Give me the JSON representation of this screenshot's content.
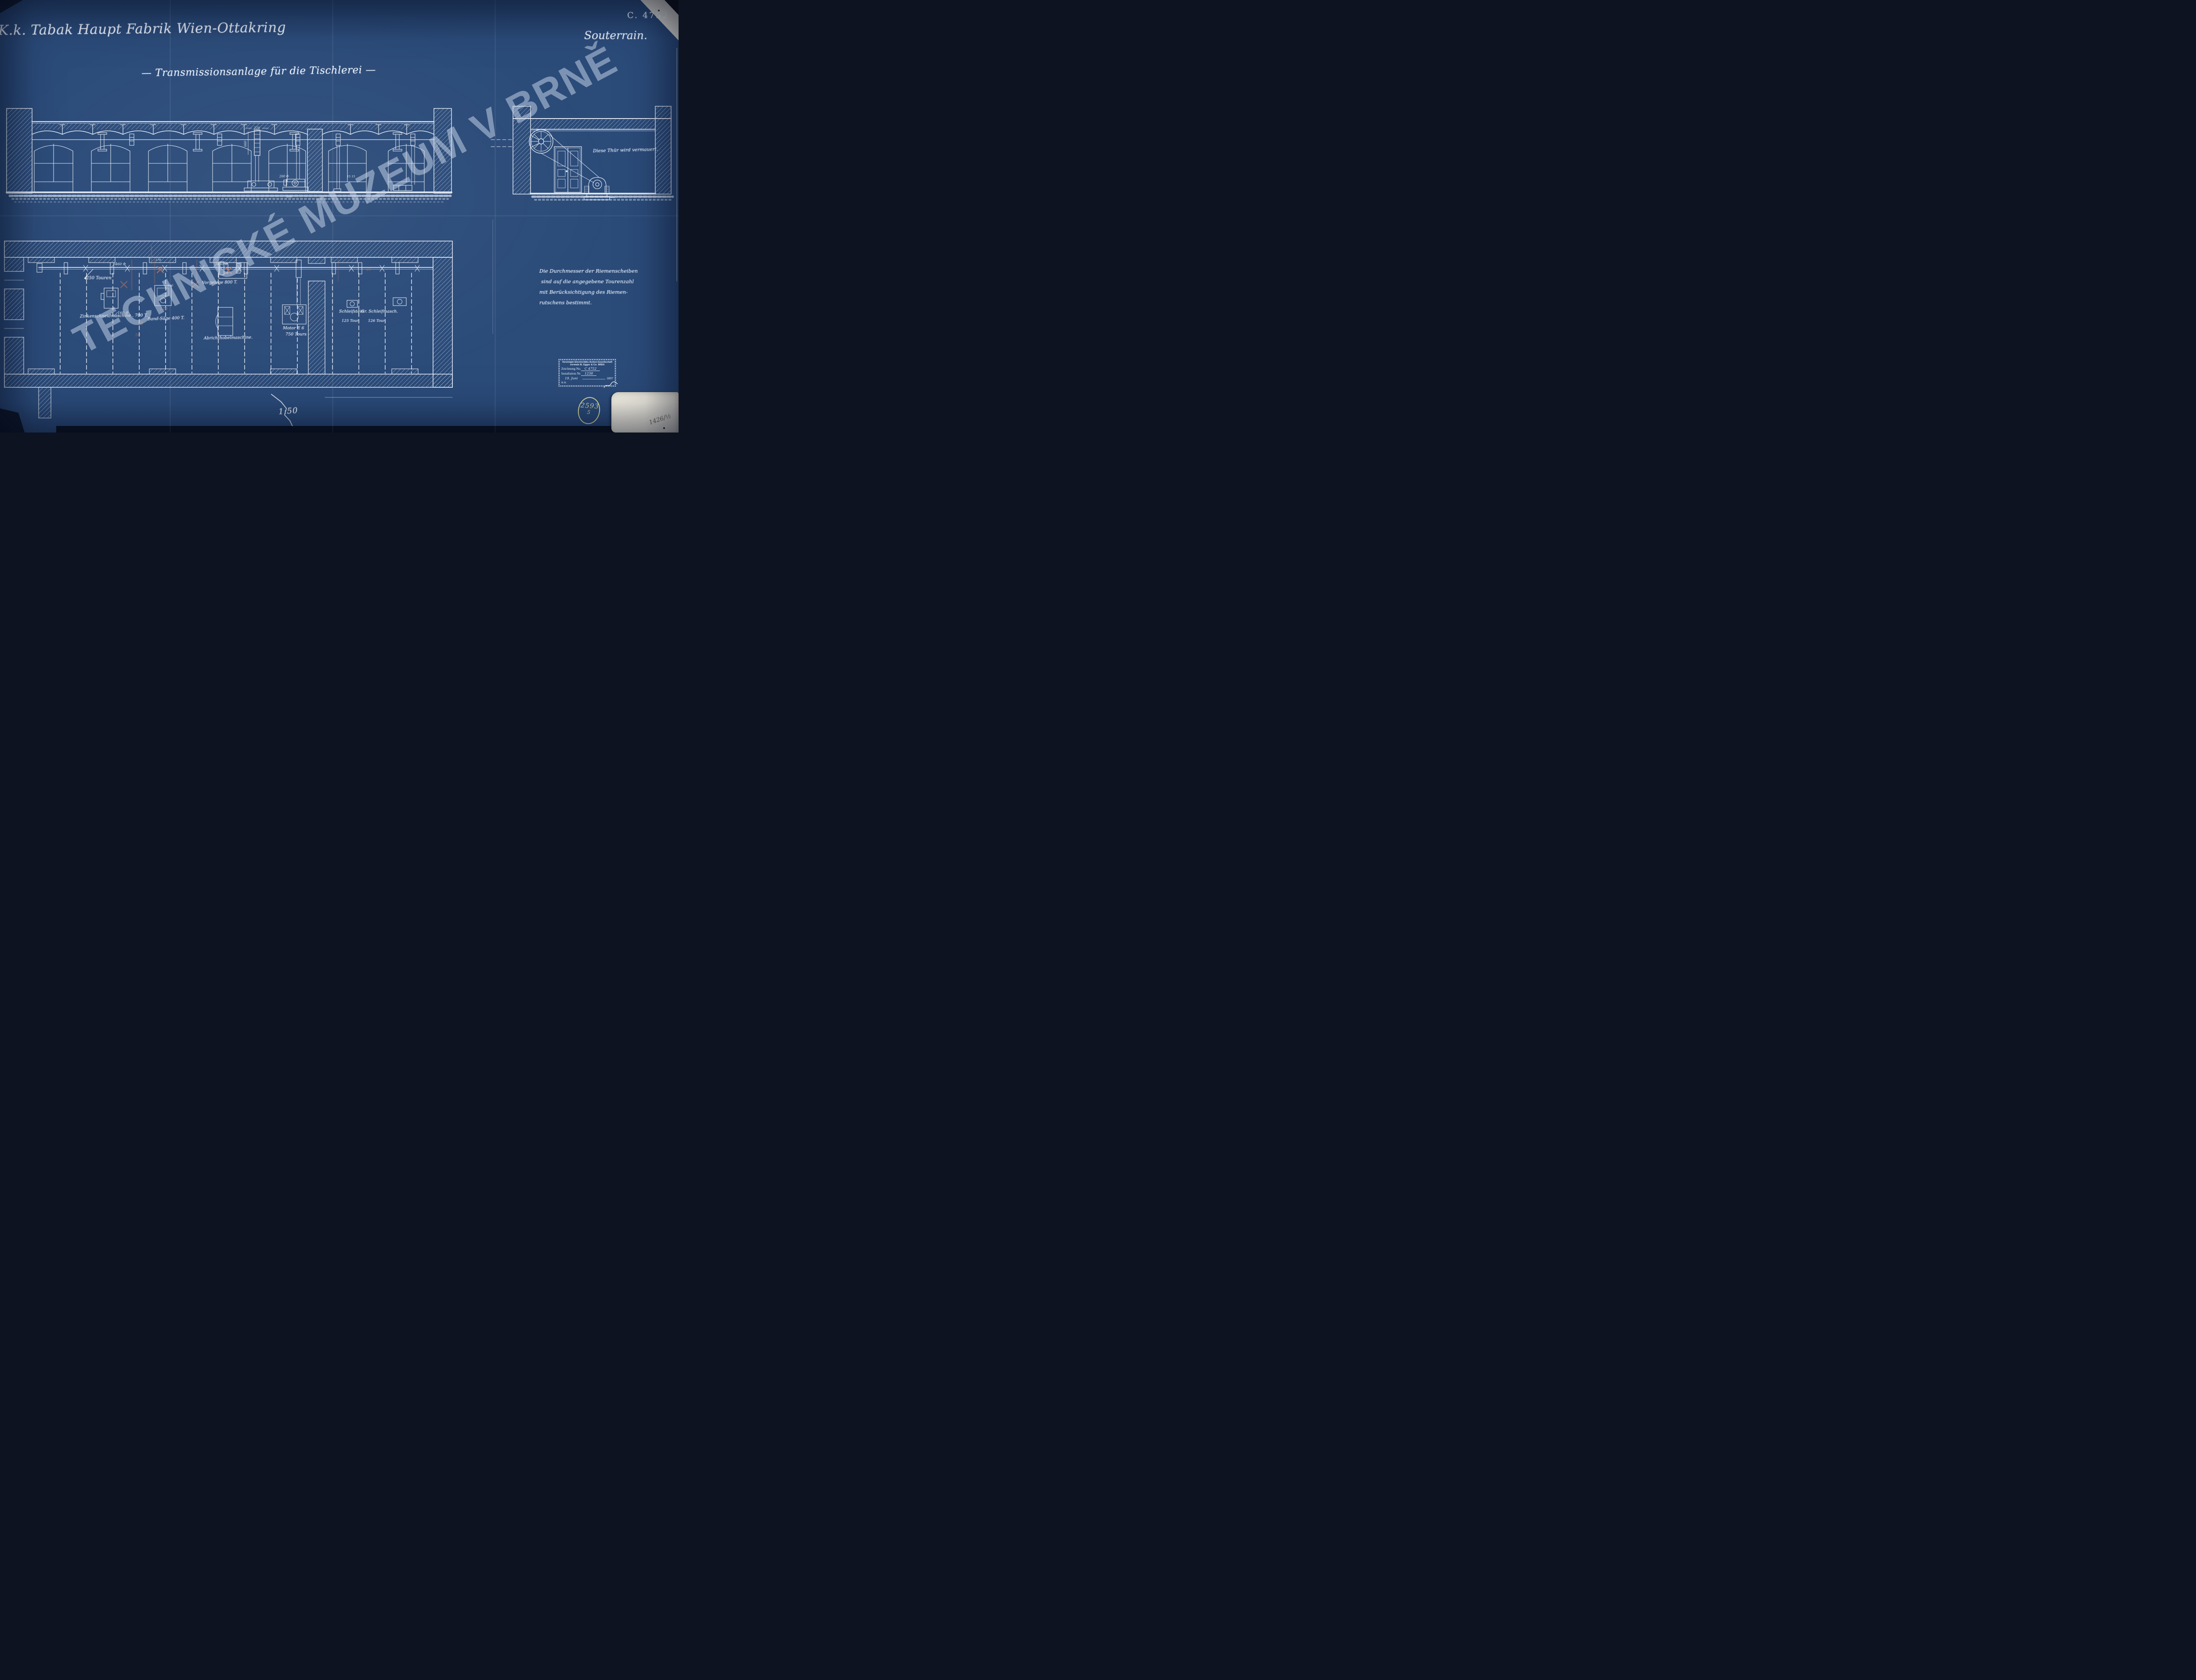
{
  "header": {
    "title": "K.k. Tabak Haupt Fabrik Wien-Ottakring",
    "subtitle": "— Transmissionsanlage für die Tischlerei —",
    "drawing_number": "C. 4752",
    "location": "Souterrain."
  },
  "watermark": "TECHNICKÉ MUZEUM V BRNĚ",
  "section": {
    "door_note": "Diese Thür wird vermauert.",
    "dims": [
      "220",
      "660",
      "200 Φ",
      "300",
      "15 15"
    ]
  },
  "plan": {
    "shaft_label": "250 Touren",
    "machines": [
      {
        "label": "Zinkenschneidmaschine . 700 T."
      },
      {
        "label": "Band-Säge 400 T."
      },
      {
        "label": "Vorgelege 800 T."
      },
      {
        "label": "Abrichthobelmaschine."
      },
      {
        "label": "Motor E 6",
        "sub": "750 Tours"
      },
      {
        "label": "Schleifstein",
        "sub": "125 Tour."
      },
      {
        "label": "Gr. Schleifmasch.",
        "sub": "126 Tour."
      }
    ],
    "dims": [
      "460 Φ",
      "440 Φ",
      "170",
      "160 Φ",
      "110"
    ],
    "pencil": [
      "50",
      "120",
      "50",
      "65"
    ]
  },
  "note": {
    "lines": [
      "Die Durchmesser der Riemenscheiben",
      "sind auf die angegebene Tourenzahl",
      "mit Berücksichtigung des Riemen-",
      "rutschens bestimmt."
    ]
  },
  "stamp": {
    "company_line1": "Vereinigte Electricitäts-Actien-Gesellschaft",
    "company_line2": "vormals B. Egger & Co. WIEN",
    "drawing_label": "Zeichnung No.",
    "drawing_value": "C 4752",
    "installation_label": "Installation Nr.",
    "installation_value": "1238",
    "date": "19. Juni",
    "year": "1897",
    "initials": "R.H."
  },
  "annotations": {
    "scale": "1:50",
    "archive_number": "2593",
    "archive_part": "5",
    "pencil_number": "1426/½"
  },
  "colors": {
    "paper": "#2b4b79",
    "ink": "#ecf2fb",
    "archive_ink": "#d3d6a2",
    "red_pencil": "#c4745a",
    "patch": "#f0ede2"
  }
}
